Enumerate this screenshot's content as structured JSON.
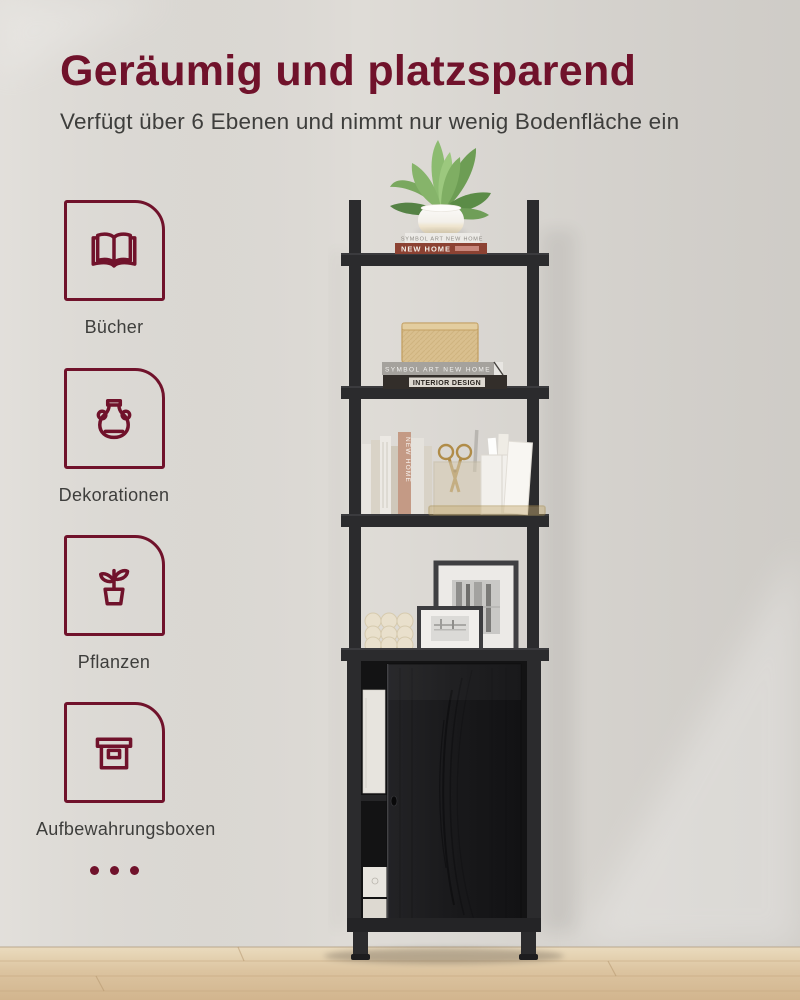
{
  "page": {
    "title": "Geräumig und platzsparend",
    "subtitle": "Verfügt über 6 Ebenen und nimmt nur wenig Bodenfläche ein"
  },
  "features": [
    {
      "icon": "open-book-icon",
      "label": "Bücher"
    },
    {
      "icon": "vase-icon",
      "label": "Dekorationen"
    },
    {
      "icon": "potted-plant-icon",
      "label": "Pflanzen"
    },
    {
      "icon": "storage-box-icon",
      "label": "Aufbewahrungsboxen"
    }
  ],
  "scene": {
    "book_spines": [
      "SYMBOL ART NEW HOME",
      "NEW HOME",
      "SYMBOL ART NEW HOME",
      "INTERIOR DESIGN",
      "NEW HOME"
    ]
  },
  "colors": {
    "accent": "#70122B",
    "text": "#3E3E3C",
    "wall": "#DFDCD7",
    "floor": "#D8C09C",
    "shelf": "#2B2B2D"
  }
}
